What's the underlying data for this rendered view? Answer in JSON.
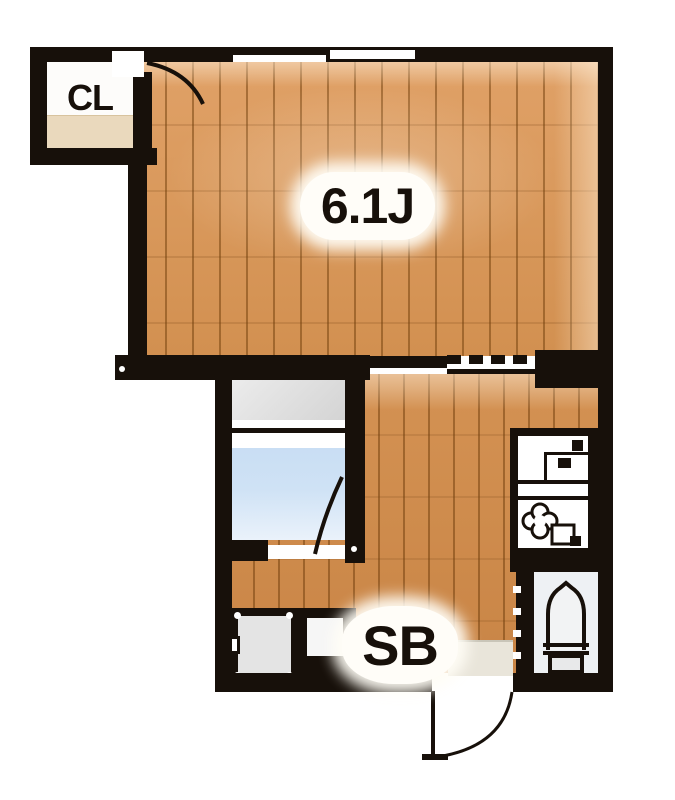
{
  "labels": {
    "main_room": "6.1J",
    "closet": "CL",
    "shoe_box": "SB"
  },
  "colors": {
    "wall": "#17100a",
    "wood-light": "#e0a167",
    "wood-dark": "#d29050",
    "wood-mid": "#d49253",
    "wood-deep": "#c98546",
    "bath-blue": "#cfe2f5",
    "vanity-gray": "#dcdcdc",
    "tile-gray": "#e9e5da",
    "toilet-floor": "#eef1f4",
    "pan-gray": "#e4e4e4",
    "closet-shelf": "#ead9bd"
  },
  "fixtures": [
    {
      "name": "closet",
      "label": "CL"
    },
    {
      "name": "window"
    },
    {
      "name": "closet-door"
    },
    {
      "name": "sliding-opening"
    },
    {
      "name": "bathroom-vanity"
    },
    {
      "name": "bathtub"
    },
    {
      "name": "bathroom-door"
    },
    {
      "name": "kitchen-sink"
    },
    {
      "name": "stove"
    },
    {
      "name": "toilet"
    },
    {
      "name": "washing-machine-pan"
    },
    {
      "name": "shoe-box",
      "label": "SB"
    },
    {
      "name": "entrance-door"
    }
  ]
}
